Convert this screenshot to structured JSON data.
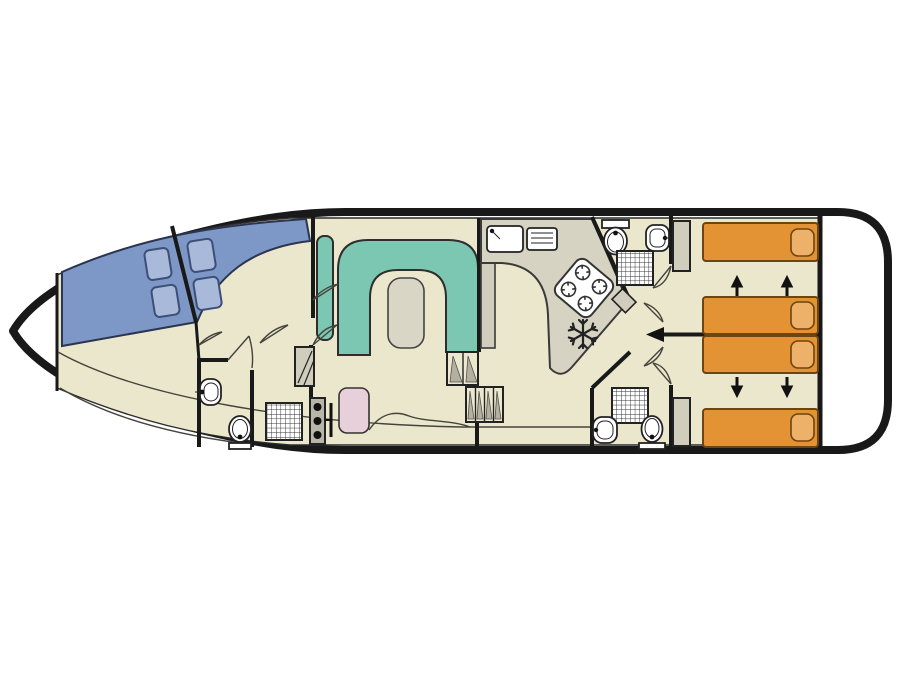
{
  "diagram": {
    "kind": "boat-deck-floor-plan",
    "orientation": "bow-left-stern-right",
    "areas": [
      {
        "id": "bow-deck",
        "name": "open bow deck"
      },
      {
        "id": "windshield",
        "name": "front window band with four opening panes"
      },
      {
        "id": "bow-washroom",
        "name": "forward washroom with sink, toilet and shower"
      },
      {
        "id": "salon",
        "name": "salon with U-shaped sofa, table, helm seat and helm console"
      },
      {
        "id": "galley",
        "name": "galley with sink, drainer, four-burner hob and fridge"
      },
      {
        "id": "mid-washroom-top",
        "name": "portside washroom with toilet, sink and shower"
      },
      {
        "id": "mid-washroom-bottom",
        "name": "starboard washroom with shower, sink and toilet"
      },
      {
        "id": "cabin-top",
        "name": "aft cabin with two sliding single beds and wardrobe"
      },
      {
        "id": "cabin-bottom",
        "name": "aft cabin with two sliding single beds and wardrobe"
      },
      {
        "id": "stern-deck",
        "name": "stern deck"
      }
    ],
    "fixture_counts": {
      "beds": 4,
      "pillows": 4,
      "toilets": 3,
      "sinks": 4,
      "showers": 3,
      "wardrobes": 3,
      "bed_slide_arrows": 4
    },
    "icons": [
      "shower-grid-icon",
      "toilet-icon",
      "sink-icon",
      "hob-burners-icon",
      "fridge-snowflake-icon",
      "steps-icon",
      "wardrobe-icon",
      "door-swing-icon",
      "bed-slide-arrow-icon",
      "passage-arrow-icon"
    ]
  },
  "colors": {
    "background": "#ffffff",
    "hull_outline": "#191919",
    "wall_black": "#191919",
    "floor_beige": "#ebe7cd",
    "window_band_blue": "#7d97c6",
    "window_pane_blue": "#a9b9da",
    "window_pane_stroke": "#3c4f78",
    "sofa_teal": "#7cc7b1",
    "table_grey": "#d9d6c6",
    "counter_grey": "#d6d3c3",
    "cabinet_grey": "#d0cdbd",
    "console_grey": "#b8b6a9",
    "step_grey": "#b3b0a2",
    "bed_orange": "#e39334",
    "bed_stroke": "#6e4412",
    "pillow_orange": "#eeb169",
    "seat_pink": "#e8d0da",
    "thin_line": "#44443c"
  }
}
